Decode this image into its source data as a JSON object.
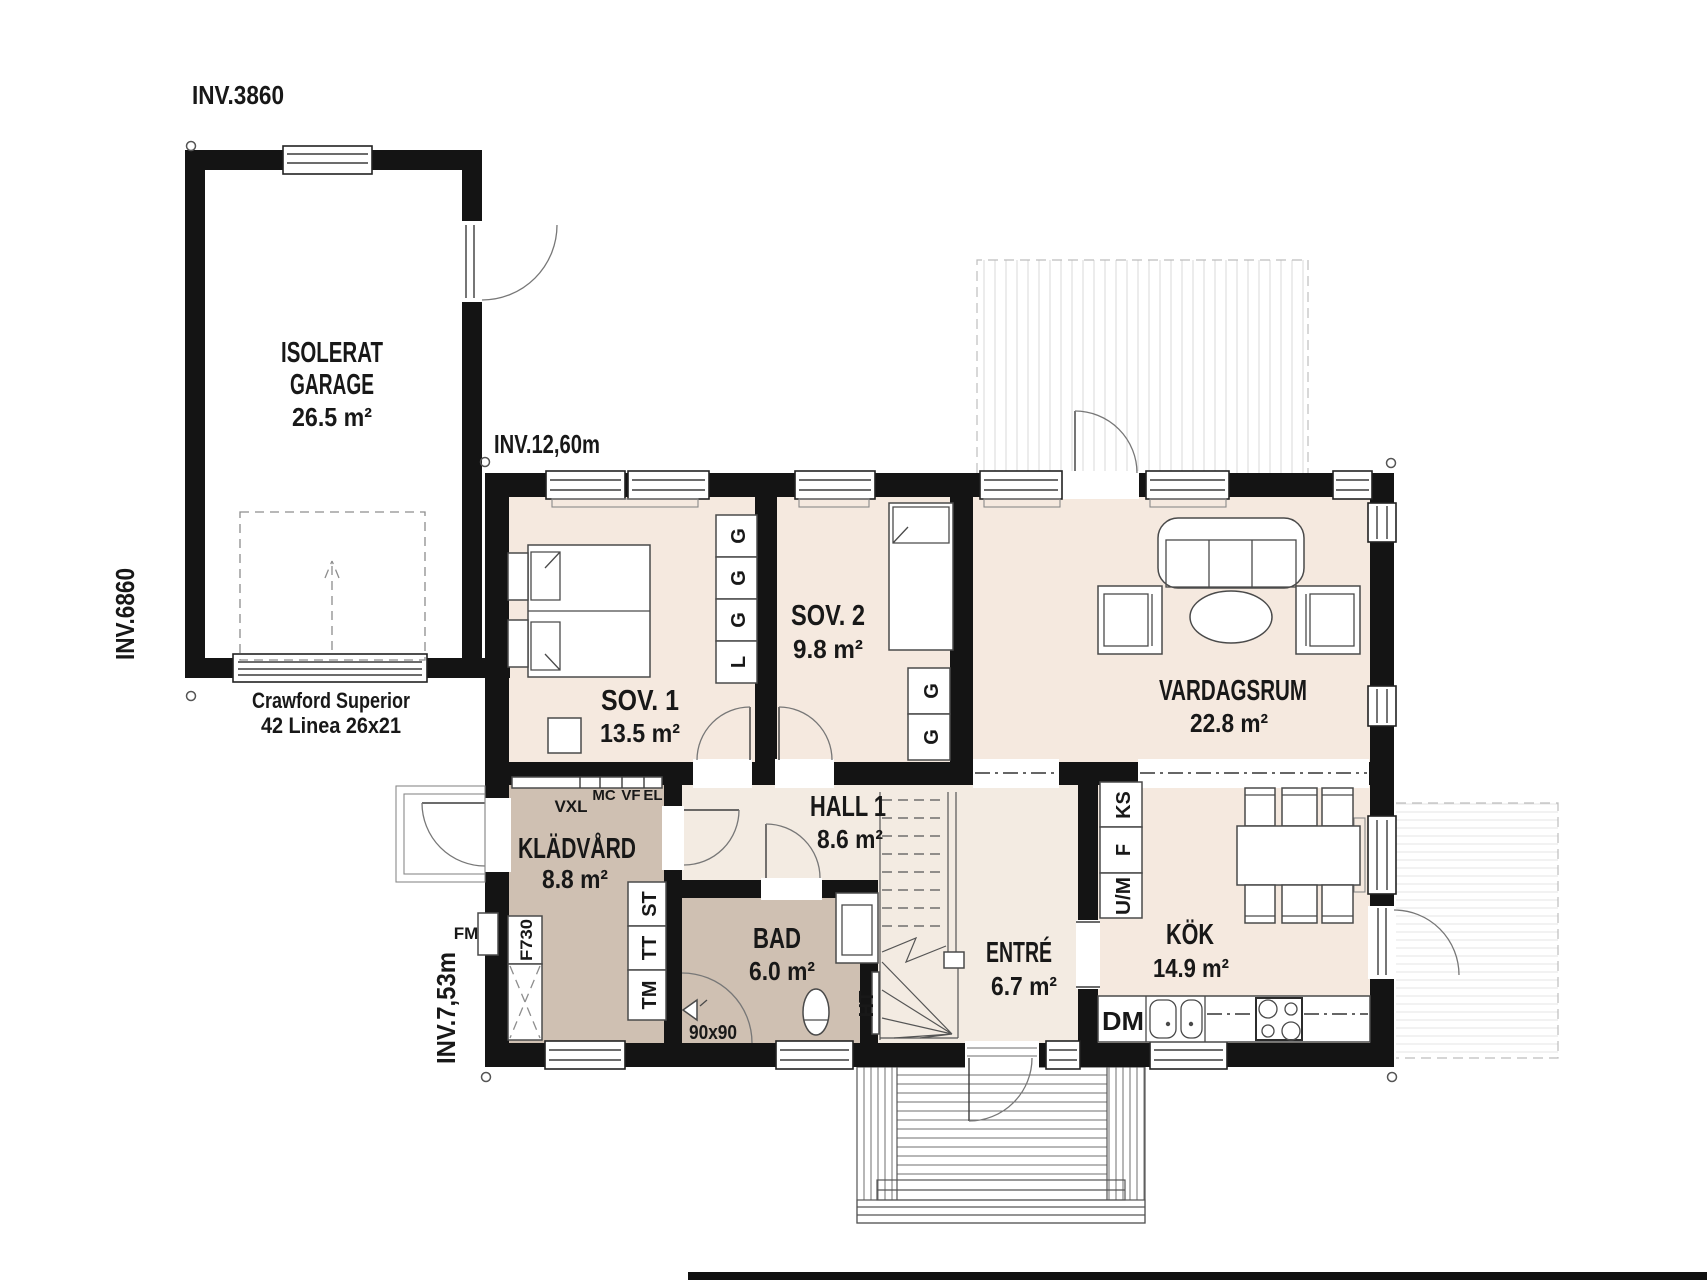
{
  "dimensions": {
    "garage_width": "INV.3860",
    "garage_depth": "INV.6860",
    "house_width": "INV.12,60m",
    "house_depth": "INV.7,53m"
  },
  "garage": {
    "name_line1": "ISOLERAT",
    "name_line2": "GARAGE",
    "area": "26.5 m²",
    "door_line1": "Crawford Superior",
    "door_line2": "42 Linea 26x21"
  },
  "rooms": {
    "sov1": {
      "name": "SOV. 1",
      "area": "13.5 m²"
    },
    "sov2": {
      "name": "SOV. 2",
      "area": "9.8 m²"
    },
    "vardagsrum": {
      "name": "VARDAGSRUM",
      "area": "22.8 m²"
    },
    "kladvard": {
      "name": "KLÄDVÅRD",
      "area": "8.8 m²"
    },
    "hall": {
      "name": "HALL 1",
      "area": "8.6 m²"
    },
    "bad": {
      "name": "BAD",
      "area": "6.0 m²"
    },
    "entre": {
      "name": "ENTRÉ",
      "area": "6.7 m²"
    },
    "kok": {
      "name": "KÖK",
      "area": "14.9 m²"
    }
  },
  "fixtures": {
    "vxl": "VXL",
    "mc": "MC",
    "vf": "VF",
    "el": "EL",
    "fm": "FM",
    "f730": "F730",
    "st": "ST",
    "tt": "TT",
    "tm": "TM",
    "ht": "HT",
    "shower_size": "90x90",
    "dm": "DM",
    "ks": "KS",
    "fridge": "F",
    "um": "U/M",
    "wardrobe": "G",
    "linen": "L"
  },
  "colors": {
    "floor_light": "#f5e9df",
    "floor_hall": "#f3ebe2",
    "floor_wet": "#cfc0b2",
    "wall": "#141414"
  }
}
